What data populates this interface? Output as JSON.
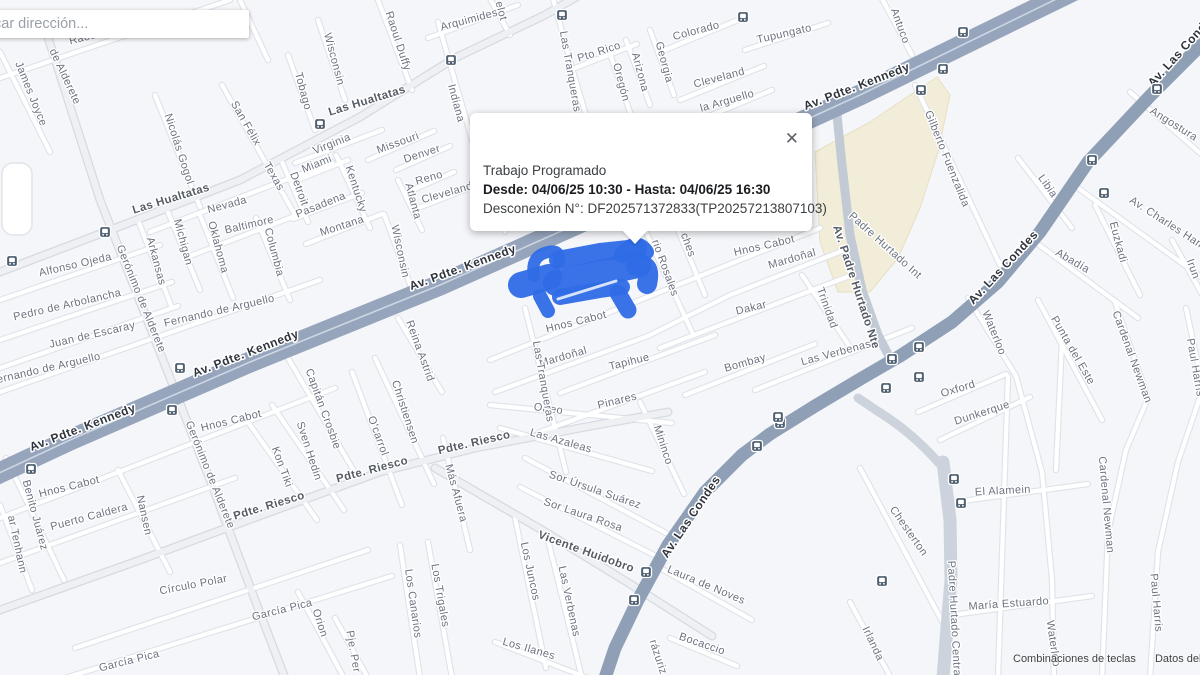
{
  "search": {
    "placeholder": "car dirección..."
  },
  "popup": {
    "title": "Trabajo Programado",
    "schedule": "Desde: 04/06/25 10:30 - Hasta: 04/06/25 16:30",
    "disconnection": "Desconexión N°: DF202571372833(TP20257213807103)",
    "close_glyph": "✕"
  },
  "attribution": {
    "keyboard_shortcuts": "Combinaciones de teclas",
    "map_data": "Datos del mapa"
  },
  "map": {
    "colors": {
      "land": "#f5f6f9",
      "minor_fill": "#ffffff",
      "minor_casing": "#dfe3e9",
      "collector_fill": "#eef0f4",
      "collector_casing": "#d6dae1",
      "kennedy": "#96a5bc",
      "las_condes": "#8e9fb6",
      "hurtado_nte": "#c2cad6",
      "hurtado_central": "#cdd3dc",
      "landmark_beige": "#f2edd8",
      "scribble_blue": "#2e6ce6",
      "transit_icon": "#4e5f70"
    },
    "labels": [
      {
        "t": "Raoul Duffy",
        "x": 100,
        "y": 37,
        "r": -14
      },
      {
        "t": "James Joyce",
        "x": 28,
        "y": 95,
        "r": 68
      },
      {
        "t": "de Alderete",
        "x": 62,
        "y": 78,
        "r": 65
      },
      {
        "t": "Nicolás Gogol",
        "x": 176,
        "y": 150,
        "r": 72
      },
      {
        "t": "San Félix",
        "x": 243,
        "y": 125,
        "r": 60
      },
      {
        "t": "Texas",
        "x": 271,
        "y": 178,
        "r": 60
      },
      {
        "t": "Las Hualtatas",
        "x": 172,
        "y": 202,
        "r": -17,
        "k": "med"
      },
      {
        "t": "Las Hualtatas",
        "x": 368,
        "y": 104,
        "r": -17,
        "k": "med"
      },
      {
        "t": "Nevada",
        "x": 228,
        "y": 208,
        "r": -15
      },
      {
        "t": "Baltimore",
        "x": 250,
        "y": 228,
        "r": -13
      },
      {
        "t": "Michigan",
        "x": 180,
        "y": 243,
        "r": 75
      },
      {
        "t": "Oklahoma",
        "x": 215,
        "y": 248,
        "r": 75
      },
      {
        "t": "Arkansas",
        "x": 153,
        "y": 262,
        "r": 75
      },
      {
        "t": "Columbia",
        "x": 271,
        "y": 253,
        "r": 75
      },
      {
        "t": "Tobago",
        "x": 300,
        "y": 92,
        "r": 75
      },
      {
        "t": "Wisconsin",
        "x": 331,
        "y": 60,
        "r": 75
      },
      {
        "t": "Wisconsin",
        "x": 397,
        "y": 252,
        "r": 78
      },
      {
        "t": "Virginia",
        "x": 333,
        "y": 147,
        "r": -22
      },
      {
        "t": "Miami",
        "x": 318,
        "y": 167,
        "r": -22
      },
      {
        "t": "Detroit",
        "x": 296,
        "y": 190,
        "r": 70
      },
      {
        "t": "Pasadena",
        "x": 322,
        "y": 208,
        "r": -22
      },
      {
        "t": "Kentucky",
        "x": 353,
        "y": 190,
        "r": 72
      },
      {
        "t": "Missouri",
        "x": 399,
        "y": 146,
        "r": -20
      },
      {
        "t": "Denver",
        "x": 423,
        "y": 157,
        "r": -18
      },
      {
        "t": "Reno",
        "x": 430,
        "y": 181,
        "r": -16
      },
      {
        "t": "Atlanta",
        "x": 410,
        "y": 202,
        "r": 75
      },
      {
        "t": "Cleveland",
        "x": 448,
        "y": 196,
        "r": -16
      },
      {
        "t": "Montana",
        "x": 343,
        "y": 229,
        "r": -18
      },
      {
        "t": "Raoul Duffy",
        "x": 395,
        "y": 42,
        "r": 72
      },
      {
        "t": "Indiana",
        "x": 453,
        "y": 104,
        "r": 75
      },
      {
        "t": "Las Tranqueras",
        "x": 567,
        "y": 72,
        "r": 80
      },
      {
        "t": "Pelot",
        "x": 497,
        "y": 8,
        "r": 75
      },
      {
        "t": "Arquimides",
        "x": 470,
        "y": 23,
        "r": -15
      },
      {
        "t": "Pto Rico",
        "x": 600,
        "y": 55,
        "r": -18
      },
      {
        "t": "Oregón",
        "x": 618,
        "y": 83,
        "r": 75
      },
      {
        "t": "Arizona",
        "x": 637,
        "y": 73,
        "r": 75
      },
      {
        "t": "Georgia",
        "x": 661,
        "y": 63,
        "r": 75
      },
      {
        "t": "Colorado",
        "x": 697,
        "y": 34,
        "r": -15
      },
      {
        "t": "Cleveland",
        "x": 720,
        "y": 81,
        "r": -15
      },
      {
        "t": "Tupungato",
        "x": 785,
        "y": 37,
        "r": -13
      },
      {
        "t": "la Arguello",
        "x": 728,
        "y": 104,
        "r": -16
      },
      {
        "t": "Antuco",
        "x": 897,
        "y": 27,
        "r": 70
      },
      {
        "t": "Av. Pdte. Kennedy",
        "x": 858,
        "y": 90,
        "r": -21,
        "k": "maj"
      },
      {
        "t": "Gilberto Fuenzalida",
        "x": 944,
        "y": 160,
        "r": 68
      },
      {
        "t": "Libia",
        "x": 1045,
        "y": 188,
        "r": 55
      },
      {
        "t": "Av. Las Condes",
        "x": 1185,
        "y": 52,
        "r": -48,
        "k": "maj"
      },
      {
        "t": "Angostura",
        "x": 1172,
        "y": 127,
        "r": 32
      },
      {
        "t": "Av. Charles Hamilton",
        "x": 1175,
        "y": 232,
        "r": 33
      },
      {
        "t": "Euzkadi",
        "x": 1115,
        "y": 243,
        "r": 75
      },
      {
        "t": "Irun",
        "x": 1190,
        "y": 270,
        "r": 70
      },
      {
        "t": "Abadía",
        "x": 1071,
        "y": 264,
        "r": 30
      },
      {
        "t": "Waterloo",
        "x": 991,
        "y": 334,
        "r": 68
      },
      {
        "t": "Punta del Este",
        "x": 1070,
        "y": 352,
        "r": 60
      },
      {
        "t": "Cardenal Newman",
        "x": 1129,
        "y": 358,
        "r": 70
      },
      {
        "t": "Cardenal Newman",
        "x": 1103,
        "y": 505,
        "r": 85
      },
      {
        "t": "Paul Harris",
        "x": 1192,
        "y": 368,
        "r": 80
      },
      {
        "t": "Paul Harris",
        "x": 1153,
        "y": 603,
        "r": 85
      },
      {
        "t": "Oxford",
        "x": 959,
        "y": 392,
        "r": -17
      },
      {
        "t": "Dunkerque",
        "x": 983,
        "y": 416,
        "r": -18
      },
      {
        "t": "El Alamein",
        "x": 1003,
        "y": 494,
        "r": -3
      },
      {
        "t": "María Estuardo",
        "x": 1009,
        "y": 607,
        "r": -4
      },
      {
        "t": "Waterloo",
        "x": 1050,
        "y": 644,
        "r": 82
      },
      {
        "t": "Chesterton",
        "x": 906,
        "y": 533,
        "r": 55
      },
      {
        "t": "Irlanda",
        "x": 870,
        "y": 645,
        "r": 65
      },
      {
        "t": "Padre Hurtado Central",
        "x": 951,
        "y": 620,
        "r": 87
      },
      {
        "t": "Av. Padre Hurtado Nte",
        "x": 853,
        "y": 288,
        "r": 72,
        "k": "med"
      },
      {
        "t": "Padre Hurtado Int",
        "x": 883,
        "y": 248,
        "r": 42
      },
      {
        "t": "Av. Las Condes",
        "x": 1006,
        "y": 270,
        "r": -47,
        "k": "maj"
      },
      {
        "t": "Av. Las Condes",
        "x": 694,
        "y": 519,
        "r": -56,
        "k": "maj"
      },
      {
        "t": "Av. Pdte. Kennedy",
        "x": 464,
        "y": 271,
        "r": -20,
        "k": "maj"
      },
      {
        "t": "Av. Pdte. Kennedy",
        "x": 247,
        "y": 357,
        "r": -21,
        "k": "maj"
      },
      {
        "t": "Av. Pdte. Kennedy",
        "x": 84,
        "y": 431,
        "r": -21,
        "k": "maj"
      },
      {
        "t": "Gerónimo de Alderete",
        "x": 138,
        "y": 300,
        "r": 68
      },
      {
        "t": "Gerónimo de Alderete",
        "x": 207,
        "y": 476,
        "r": 68
      },
      {
        "t": "Alfonso Ojeda",
        "x": 76,
        "y": 268,
        "r": -13
      },
      {
        "t": "Pedro de Arbolancha",
        "x": 68,
        "y": 308,
        "r": -13
      },
      {
        "t": "Juan de Escaray",
        "x": 93,
        "y": 338,
        "r": -13
      },
      {
        "t": "Fernando de Arguello",
        "x": 220,
        "y": 314,
        "r": -13
      },
      {
        "t": "Fernando de Arguello",
        "x": 46,
        "y": 372,
        "r": -13
      },
      {
        "t": "Hnos Cabot",
        "x": 765,
        "y": 249,
        "r": -13
      },
      {
        "t": "Hnos Cabot",
        "x": 577,
        "y": 325,
        "r": -14
      },
      {
        "t": "Hnos Cabot",
        "x": 232,
        "y": 424,
        "r": -14
      },
      {
        "t": "Hnos Cabot",
        "x": 70,
        "y": 490,
        "r": -14
      },
      {
        "t": "Mardoñal",
        "x": 564,
        "y": 360,
        "r": -16
      },
      {
        "t": "Mardoñal",
        "x": 793,
        "y": 262,
        "r": -16
      },
      {
        "t": "rio Rosales",
        "x": 662,
        "y": 269,
        "r": 70
      },
      {
        "t": "ches",
        "x": 685,
        "y": 246,
        "r": 70
      },
      {
        "t": "Dakar",
        "x": 752,
        "y": 311,
        "r": -14
      },
      {
        "t": "Trinidad",
        "x": 824,
        "y": 309,
        "r": 70
      },
      {
        "t": "Bombay",
        "x": 746,
        "y": 366,
        "r": -16
      },
      {
        "t": "Las Verbenas",
        "x": 837,
        "y": 356,
        "r": -15
      },
      {
        "t": "Las Verbenas",
        "x": 566,
        "y": 602,
        "r": 78
      },
      {
        "t": "Tapihue",
        "x": 630,
        "y": 365,
        "r": -14
      },
      {
        "t": "Mininco",
        "x": 660,
        "y": 446,
        "r": 72
      },
      {
        "t": "Pinares",
        "x": 618,
        "y": 404,
        "r": -14
      },
      {
        "t": "Orfeo",
        "x": 548,
        "y": 412,
        "r": 8
      },
      {
        "t": "Pdte. Riesco",
        "x": 270,
        "y": 509,
        "r": -17,
        "k": "med"
      },
      {
        "t": "Pdte. Riesco",
        "x": 373,
        "y": 473,
        "r": -15,
        "k": "med"
      },
      {
        "t": "Pdte. Riesco",
        "x": 475,
        "y": 446,
        "r": -13,
        "k": "med"
      },
      {
        "t": "Reina Astrid",
        "x": 417,
        "y": 352,
        "r": 70
      },
      {
        "t": "Christiensen",
        "x": 402,
        "y": 413,
        "r": 72
      },
      {
        "t": "O'carrol",
        "x": 375,
        "y": 437,
        "r": 70
      },
      {
        "t": "Capitán Crosbie",
        "x": 320,
        "y": 410,
        "r": 70
      },
      {
        "t": "Sven Hedin",
        "x": 306,
        "y": 452,
        "r": 72
      },
      {
        "t": "Kon Tiki",
        "x": 279,
        "y": 468,
        "r": 70
      },
      {
        "t": "Benito Juárez",
        "x": 32,
        "y": 516,
        "r": 75
      },
      {
        "t": "ar Tenhann",
        "x": 14,
        "y": 545,
        "r": 78
      },
      {
        "t": "Puerto Caldera",
        "x": 90,
        "y": 520,
        "r": -15
      },
      {
        "t": "Nansen",
        "x": 141,
        "y": 516,
        "r": 78
      },
      {
        "t": "Círculo Polar",
        "x": 194,
        "y": 588,
        "r": -11
      },
      {
        "t": "García Pica",
        "x": 283,
        "y": 613,
        "r": -14
      },
      {
        "t": "García Pica",
        "x": 130,
        "y": 664,
        "r": -14
      },
      {
        "t": "Orion",
        "x": 317,
        "y": 624,
        "r": 72
      },
      {
        "t": "Pje. Per",
        "x": 350,
        "y": 652,
        "r": 80
      },
      {
        "t": "Los Canarios",
        "x": 410,
        "y": 604,
        "r": 82
      },
      {
        "t": "Los Trigales",
        "x": 437,
        "y": 596,
        "r": 80
      },
      {
        "t": "Los Juncos",
        "x": 527,
        "y": 572,
        "r": 78
      },
      {
        "t": "Los Ilanes",
        "x": 528,
        "y": 652,
        "r": 16
      },
      {
        "t": "Las Azaleas",
        "x": 560,
        "y": 444,
        "r": 16
      },
      {
        "t": "Sor Úrsula Suárez",
        "x": 594,
        "y": 493,
        "r": 19
      },
      {
        "t": "Sor Laura Rosa",
        "x": 582,
        "y": 518,
        "r": 19
      },
      {
        "t": "Vicente Huidobro",
        "x": 585,
        "y": 555,
        "r": 20,
        "k": "med"
      },
      {
        "t": "Laura de Noves",
        "x": 705,
        "y": 588,
        "r": 23
      },
      {
        "t": "Bocaccio",
        "x": 701,
        "y": 647,
        "r": 19
      },
      {
        "t": "rázuriz",
        "x": 655,
        "y": 658,
        "r": 72
      },
      {
        "t": "Más Afuera",
        "x": 453,
        "y": 494,
        "r": 75
      },
      {
        "t": "Las Tranqueras",
        "x": 540,
        "y": 382,
        "r": 80
      }
    ],
    "transit_icons": [
      {
        "x": 105,
        "y": 232
      },
      {
        "x": 320,
        "y": 124
      },
      {
        "x": 451,
        "y": 60
      },
      {
        "x": 562,
        "y": 15
      },
      {
        "x": 743,
        "y": 17
      },
      {
        "x": 963,
        "y": 32
      },
      {
        "x": 943,
        "y": 69
      },
      {
        "x": 921,
        "y": 90
      },
      {
        "x": 1157,
        "y": 89
      },
      {
        "x": 1092,
        "y": 160
      },
      {
        "x": 1104,
        "y": 193
      },
      {
        "x": 12,
        "y": 261
      },
      {
        "x": 180,
        "y": 368
      },
      {
        "x": 172,
        "y": 410
      },
      {
        "x": 31,
        "y": 469
      },
      {
        "x": 780,
        "y": 423
      },
      {
        "x": 757,
        "y": 446
      },
      {
        "x": 646,
        "y": 572
      },
      {
        "x": 634,
        "y": 600
      },
      {
        "x": 919,
        "y": 347
      },
      {
        "x": 892,
        "y": 359
      },
      {
        "x": 919,
        "y": 377
      },
      {
        "x": 886,
        "y": 388
      },
      {
        "x": 778,
        "y": 417
      },
      {
        "x": 954,
        "y": 479
      },
      {
        "x": 961,
        "y": 503
      },
      {
        "x": 882,
        "y": 581
      }
    ]
  }
}
